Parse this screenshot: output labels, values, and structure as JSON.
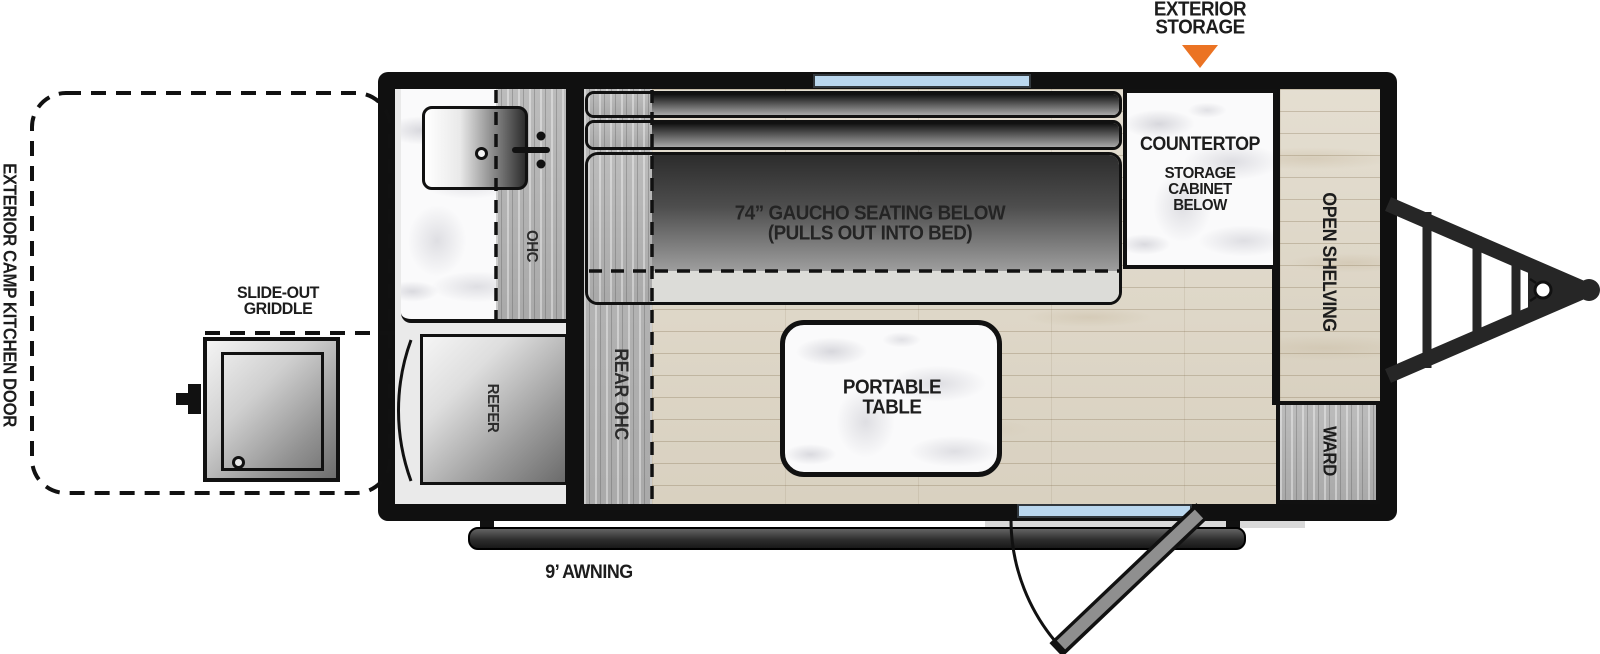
{
  "diagram": {
    "type": "rv-travel-trailer-floorplan",
    "callouts": {
      "exterior_storage_line1": "EXTERIOR",
      "exterior_storage_line2": "STORAGE",
      "slide_out_griddle_line1": "SLIDE-OUT",
      "slide_out_griddle_line2": "GRIDDLE",
      "exterior_camp_kitchen_door": "EXTERIOR CAMP KITCHEN DOOR",
      "awning": "9’ AWNING"
    },
    "interior": {
      "gaucho_line1": "74” GAUCHO SEATING BELOW",
      "gaucho_line2": "(PULLS OUT INTO BED)",
      "portable_table_line1": "PORTABLE",
      "portable_table_line2": "TABLE",
      "countertop": "COUNTERTOP",
      "storage_line1": "STORAGE",
      "storage_line2": "CABINET",
      "storage_line3": "BELOW",
      "open_shelving": "OPEN SHELVING",
      "ward": "WARD",
      "rear_ohc": "REAR OHC",
      "ohc": "OHC",
      "refer": "REFER"
    },
    "colors": {
      "callout_arrow_orange": "#EB7323",
      "window_blue": "#BAD7EE",
      "line_black": "#111111"
    }
  }
}
